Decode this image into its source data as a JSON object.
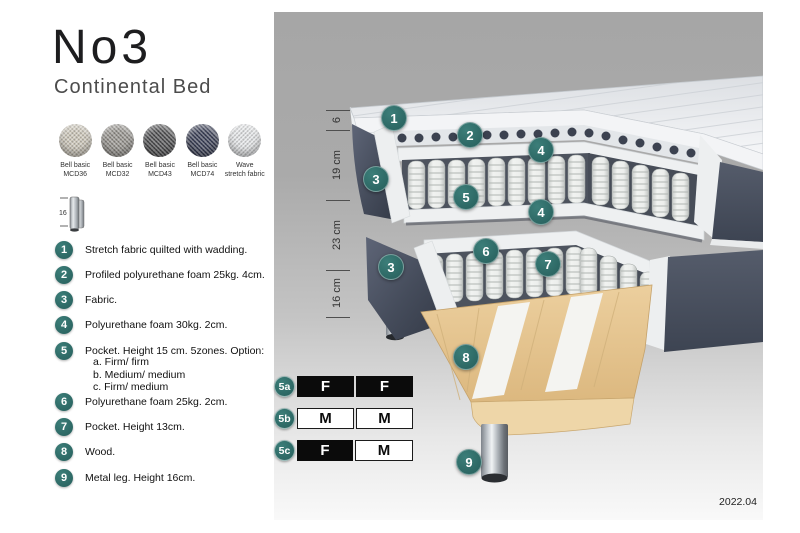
{
  "title": "No3",
  "subtitle": "Continental Bed",
  "colors": {
    "accent_teal": "#2d6e6a",
    "slate_fabric": "#474e5c",
    "wood": "#e7c897",
    "spring_white": "#eceeec",
    "swatch_mcd36": "#cfc9bb",
    "swatch_mcd32": "#97948e",
    "swatch_mcd43": "#4f4f51",
    "swatch_mcd74": "#3b4057",
    "swatch_wave": "#e7e9eb"
  },
  "swatches": [
    {
      "line1": "Bell basic",
      "line2": "MCD36"
    },
    {
      "line1": "Bell basic",
      "line2": "MCD32"
    },
    {
      "line1": "Bell basic",
      "line2": "MCD43"
    },
    {
      "line1": "Bell basic",
      "line2": "MCD74"
    },
    {
      "line1": "Wave",
      "line2": "stretch fabric"
    }
  ],
  "leg_icon": {
    "height_label": "16"
  },
  "legend": [
    {
      "num": "1",
      "text": "Stretch fabric quilted with wadding."
    },
    {
      "num": "2",
      "text": "Profiled polyurethane foam 25kg. 4cm."
    },
    {
      "num": "3",
      "text": "Fabric."
    },
    {
      "num": "4",
      "text": "Polyurethane foam 30kg. 2cm."
    },
    {
      "num": "5",
      "text": "Pocket. Height 15 cm. 5zones. Option:",
      "options": [
        "a. Firm/ firm",
        "b. Medium/ medium",
        "c. Firm/ medium"
      ]
    },
    {
      "num": "6",
      "text": "Polyurethane foam 25kg. 2cm."
    },
    {
      "num": "7",
      "text": "Pocket. Height 13cm."
    },
    {
      "num": "8",
      "text": "Wood."
    },
    {
      "num": "9",
      "text": "Metal leg. Height 16cm."
    }
  ],
  "dimensions": {
    "topper": "6",
    "upper_mattress": "19 cm",
    "lower_box": "23 cm",
    "legs": "16 cm"
  },
  "callouts": {
    "c1": "1",
    "c2": "2",
    "c4a": "4",
    "c3a": "3",
    "c5": "5",
    "c4b": "4",
    "c6": "6",
    "c3b": "3",
    "c7": "7",
    "c8": "8",
    "c9": "9"
  },
  "firmness_options": [
    {
      "label": "5a",
      "cells": [
        {
          "value": "F",
          "style": "dark"
        },
        {
          "value": "F",
          "style": "dark"
        }
      ]
    },
    {
      "label": "5b",
      "cells": [
        {
          "value": "M",
          "style": "light"
        },
        {
          "value": "M",
          "style": "light"
        }
      ]
    },
    {
      "label": "5c",
      "cells": [
        {
          "value": "F",
          "style": "dark"
        },
        {
          "value": "M",
          "style": "light"
        }
      ]
    }
  ],
  "version": "2022.04"
}
